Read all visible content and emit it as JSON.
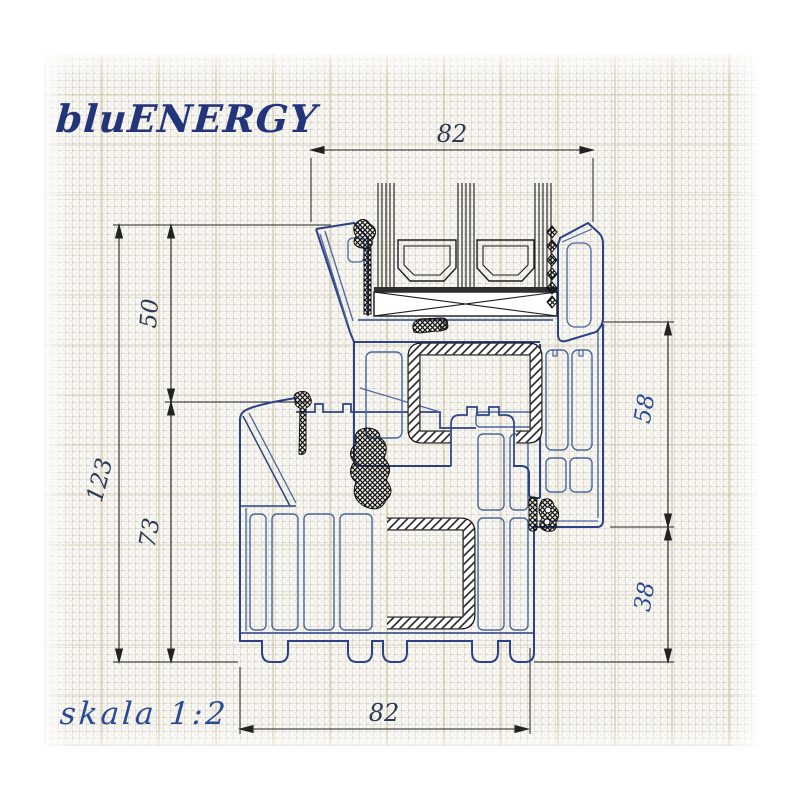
{
  "header": {
    "logo": "bluENERGY",
    "scale_note": "skala 1:2"
  },
  "dims": {
    "top_width": "82",
    "bottom_width": "82",
    "left_total": "123",
    "left_upper": "50",
    "left_lower": "73",
    "right_upper": "58",
    "right_lower": "38"
  },
  "colors": {
    "profile_blue": "#2c4284",
    "profile_blue_light": "#4a66a0",
    "ink_black": "#1f1f1f",
    "logo_blue": "#22357b",
    "dim_blue": "#2b4a94",
    "paper": "#fbfaf6"
  }
}
